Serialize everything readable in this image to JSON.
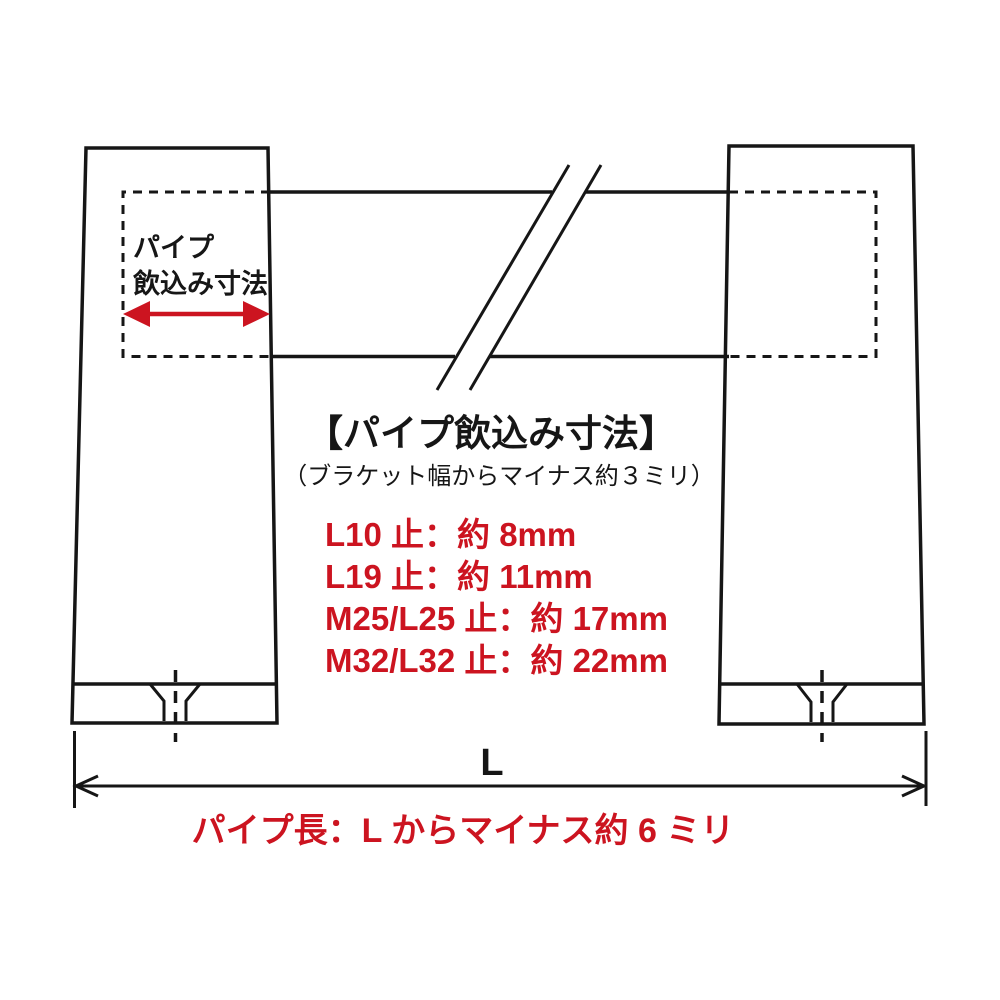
{
  "diagram": {
    "bracket_label": {
      "line1": "パイプ",
      "line2": "飲込み寸法"
    },
    "title": "【パイプ飲込み寸法】",
    "subtitle": "（ブラケット幅からマイナス約３ミリ）",
    "specs": [
      "L10 止：約 8mm",
      "L19 止：約 11mm",
      "M25/L25 止：約 17mm",
      "M32/L32 止：約 22mm"
    ],
    "dimension_label": "L",
    "pipe_length_note": "パイプ長：L からマイナス約 6 ミリ",
    "colors": {
      "accent_red": "#cc1420",
      "line_black": "#161616"
    }
  }
}
